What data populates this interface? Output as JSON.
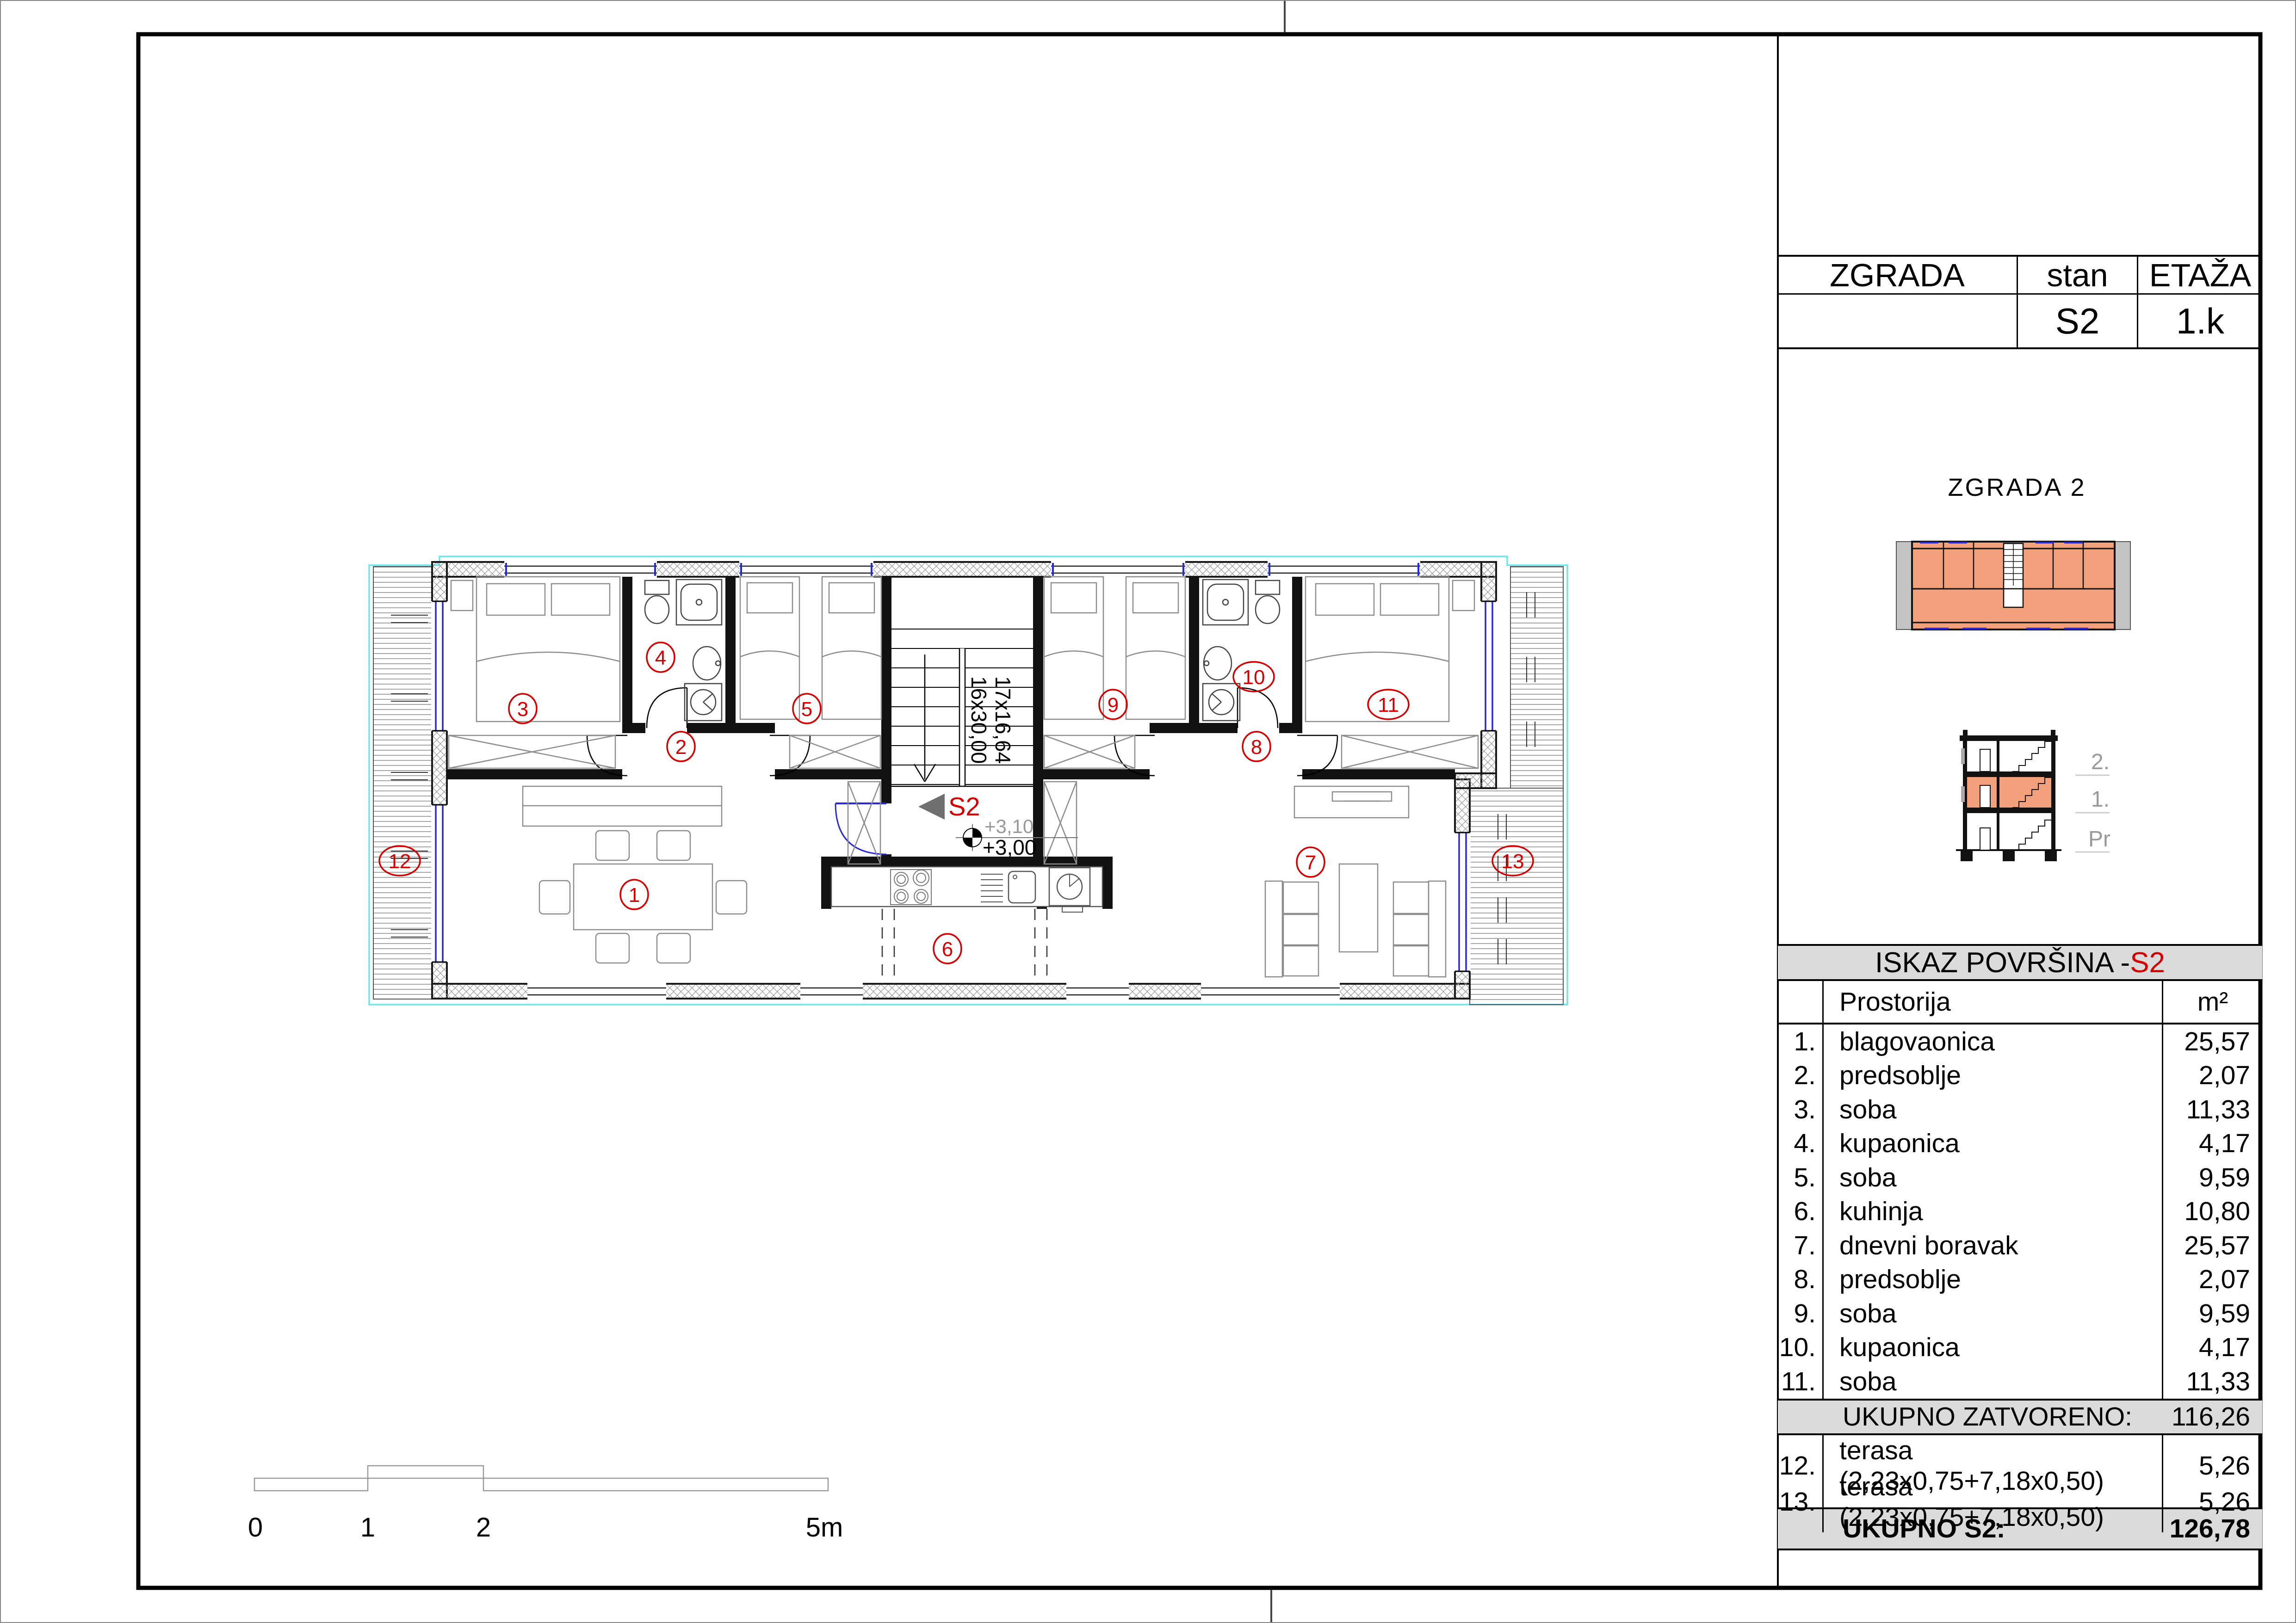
{
  "title_block": {
    "col_zgrada": "ZGRADA",
    "col_stan": "stan",
    "col_etaza": "ETAŽA",
    "building_value": "",
    "stan_value": "S2",
    "etaza_value": "1.k"
  },
  "building_label": "ZGRADA  2",
  "section": {
    "labels": [
      "2.",
      "1.",
      "Pr"
    ]
  },
  "areas_table": {
    "title_prefix": "ISKAZ POVRŠINA - ",
    "title_unit": "S2",
    "col_room": "Prostorija",
    "col_m2": "m²",
    "rows": [
      {
        "num": "1.",
        "name": "blagovaonica",
        "value": "25,57"
      },
      {
        "num": "2.",
        "name": "predsoblje",
        "value": "2,07"
      },
      {
        "num": "3.",
        "name": "soba",
        "value": "11,33"
      },
      {
        "num": "4.",
        "name": "kupaonica",
        "value": "4,17"
      },
      {
        "num": "5.",
        "name": "soba",
        "value": "9,59"
      },
      {
        "num": "6.",
        "name": "kuhinja",
        "value": "10,80"
      },
      {
        "num": "7.",
        "name": "dnevni boravak",
        "value": "25,57"
      },
      {
        "num": "8.",
        "name": "predsoblje",
        "value": "2,07"
      },
      {
        "num": "9.",
        "name": "soba",
        "value": "9,59"
      },
      {
        "num": "10.",
        "name": "kupaonica",
        "value": "4,17"
      },
      {
        "num": "11.",
        "name": "soba",
        "value": "11,33"
      }
    ],
    "subtotal_label": "UKUPNO ZATVORENO:",
    "subtotal_value": "116,26",
    "terrace_rows": [
      {
        "num": "12.",
        "name": "terasa  (2,23x0,75+7,18x0,50)",
        "value": "5,26"
      },
      {
        "num": "13.",
        "name": "terasa  (2,23x0,75+7,18x0,50)",
        "value": "5,26"
      }
    ],
    "total_label": "UKUPNO S2:",
    "total_value": "126,78"
  },
  "plan": {
    "unit_label": "S2",
    "elevation_upper": "+3,10",
    "elevation_lower": "+3,00",
    "stair_line1": "17x16,64",
    "stair_line2": "16x30,00",
    "room_labels": [
      {
        "n": "1"
      },
      {
        "n": "2"
      },
      {
        "n": "3"
      },
      {
        "n": "4"
      },
      {
        "n": "5"
      },
      {
        "n": "6"
      },
      {
        "n": "7"
      },
      {
        "n": "8"
      },
      {
        "n": "9"
      },
      {
        "n": "10"
      },
      {
        "n": "11"
      },
      {
        "n": "12"
      },
      {
        "n": "13"
      }
    ]
  },
  "scale_bar": {
    "labels": [
      "0",
      "1",
      "2",
      "5m"
    ]
  },
  "colors": {
    "label_red": "#D40000",
    "room_fill_salmon": "#F2A17C",
    "window_blue": "#2A2AD4",
    "unit_boundary_cyan": "#70E6EC",
    "table_bar_gray": "#DBDBDB"
  }
}
